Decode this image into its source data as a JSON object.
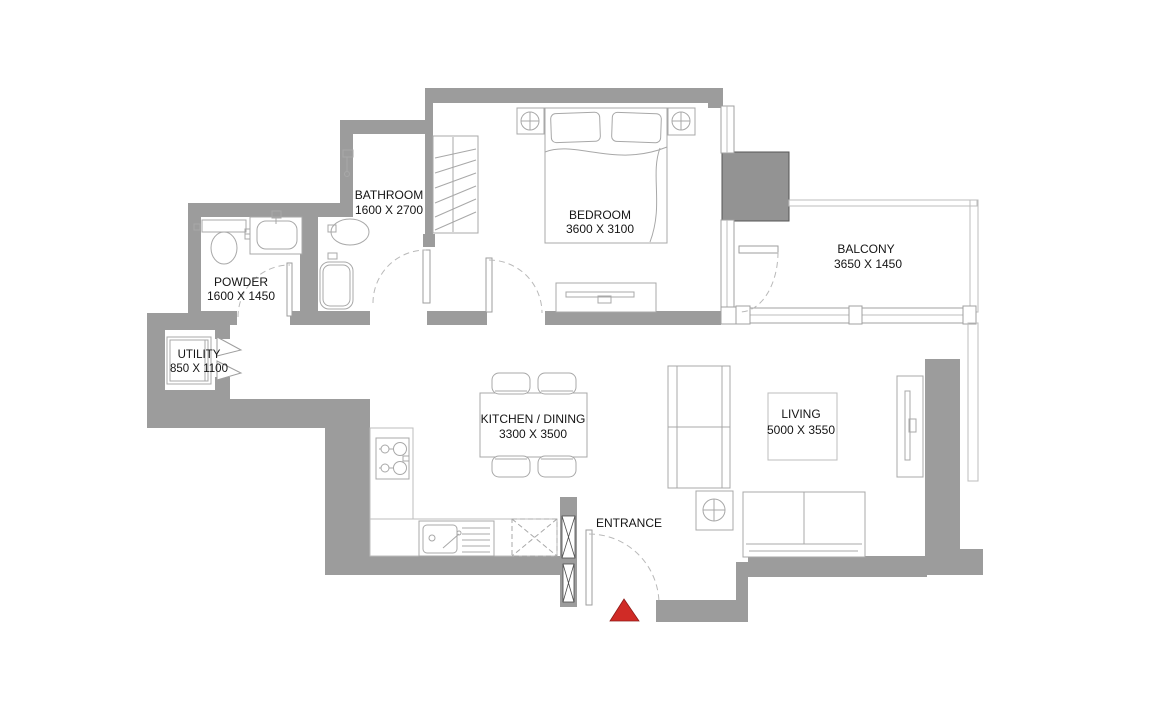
{
  "plan": {
    "rooms": {
      "bathroom": {
        "name": "BATHROOM",
        "dims": "1600 X 2700"
      },
      "bedroom": {
        "name": "BEDROOM",
        "dims": "3600 X 3100"
      },
      "balcony": {
        "name": "BALCONY",
        "dims": "3650 X 1450"
      },
      "powder": {
        "name": "POWDER",
        "dims": "1600 X 1450"
      },
      "utility": {
        "name": "UTILITY",
        "dims": "850 X 1100"
      },
      "kitchen_dining": {
        "name": "KITCHEN / DINING",
        "dims": "3300 X 3500"
      },
      "living": {
        "name": "LIVING",
        "dims": "5000 X 3550"
      },
      "entrance": {
        "name": "ENTRANCE"
      }
    },
    "colors": {
      "wall": "#9c9c9c",
      "column": "#939393",
      "entrance_marker": "#d02b26"
    }
  }
}
